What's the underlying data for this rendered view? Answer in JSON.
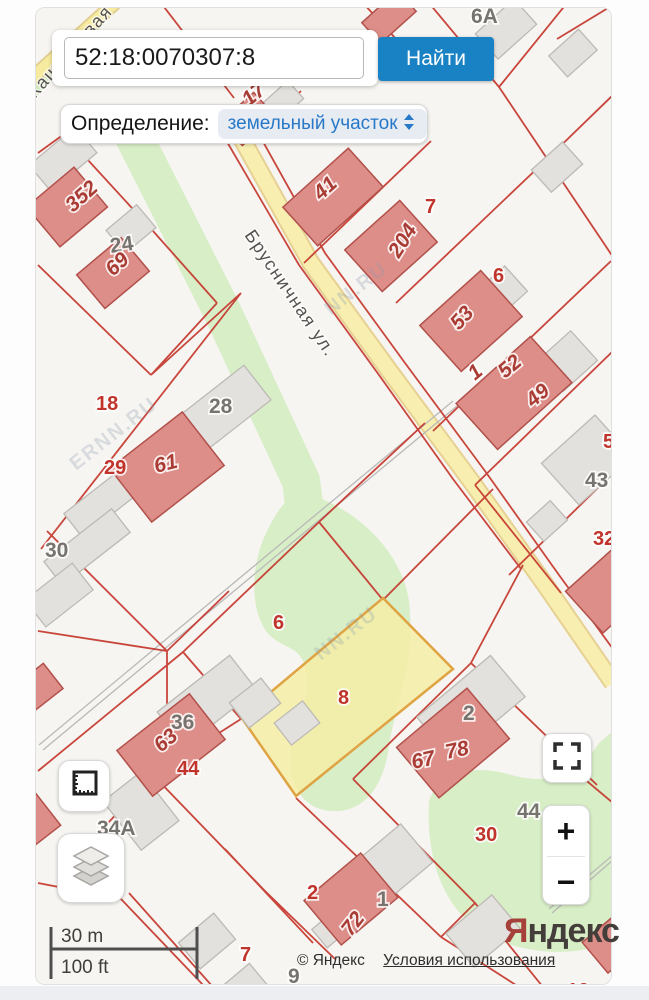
{
  "search": {
    "value": "52:18:0070307:8",
    "button_label": "Найти"
  },
  "definition": {
    "label": "Определение:",
    "value": "земельный участок"
  },
  "map": {
    "street_main": "Брусничная ул.",
    "street_secondary": "Каштановая",
    "watermarks": [
      "NN.RU",
      "ERNN.RU",
      "NN.RU"
    ],
    "highlighted_parcel": "8",
    "labels": [
      "352",
      "24",
      "69",
      "6A",
      "17",
      "41",
      "7",
      "204",
      "6",
      "53",
      "1",
      "52",
      "49",
      "5",
      "43",
      "32",
      "18",
      "28",
      "29",
      "61",
      "30",
      "6",
      "8",
      "36",
      "63",
      "44",
      "34A",
      "67",
      "78",
      "2",
      "44",
      "30",
      "2",
      "1",
      "72",
      "7",
      "9",
      "12"
    ]
  },
  "scale": {
    "metric": "30 m",
    "imperial": "100 ft"
  },
  "attribution": {
    "copyright": "© Яндекс",
    "terms_link": "Условия использования"
  },
  "logo": {
    "ya": "Я",
    "rest": "ндекс"
  },
  "controls": {
    "zoom_in": "+",
    "zoom_out": "−"
  },
  "colors": {
    "accent_blue": "#1982c4",
    "parcel_red": "#c3362c",
    "highlight_yellow": "#f5eda6",
    "green_area": "#d8eec7"
  }
}
